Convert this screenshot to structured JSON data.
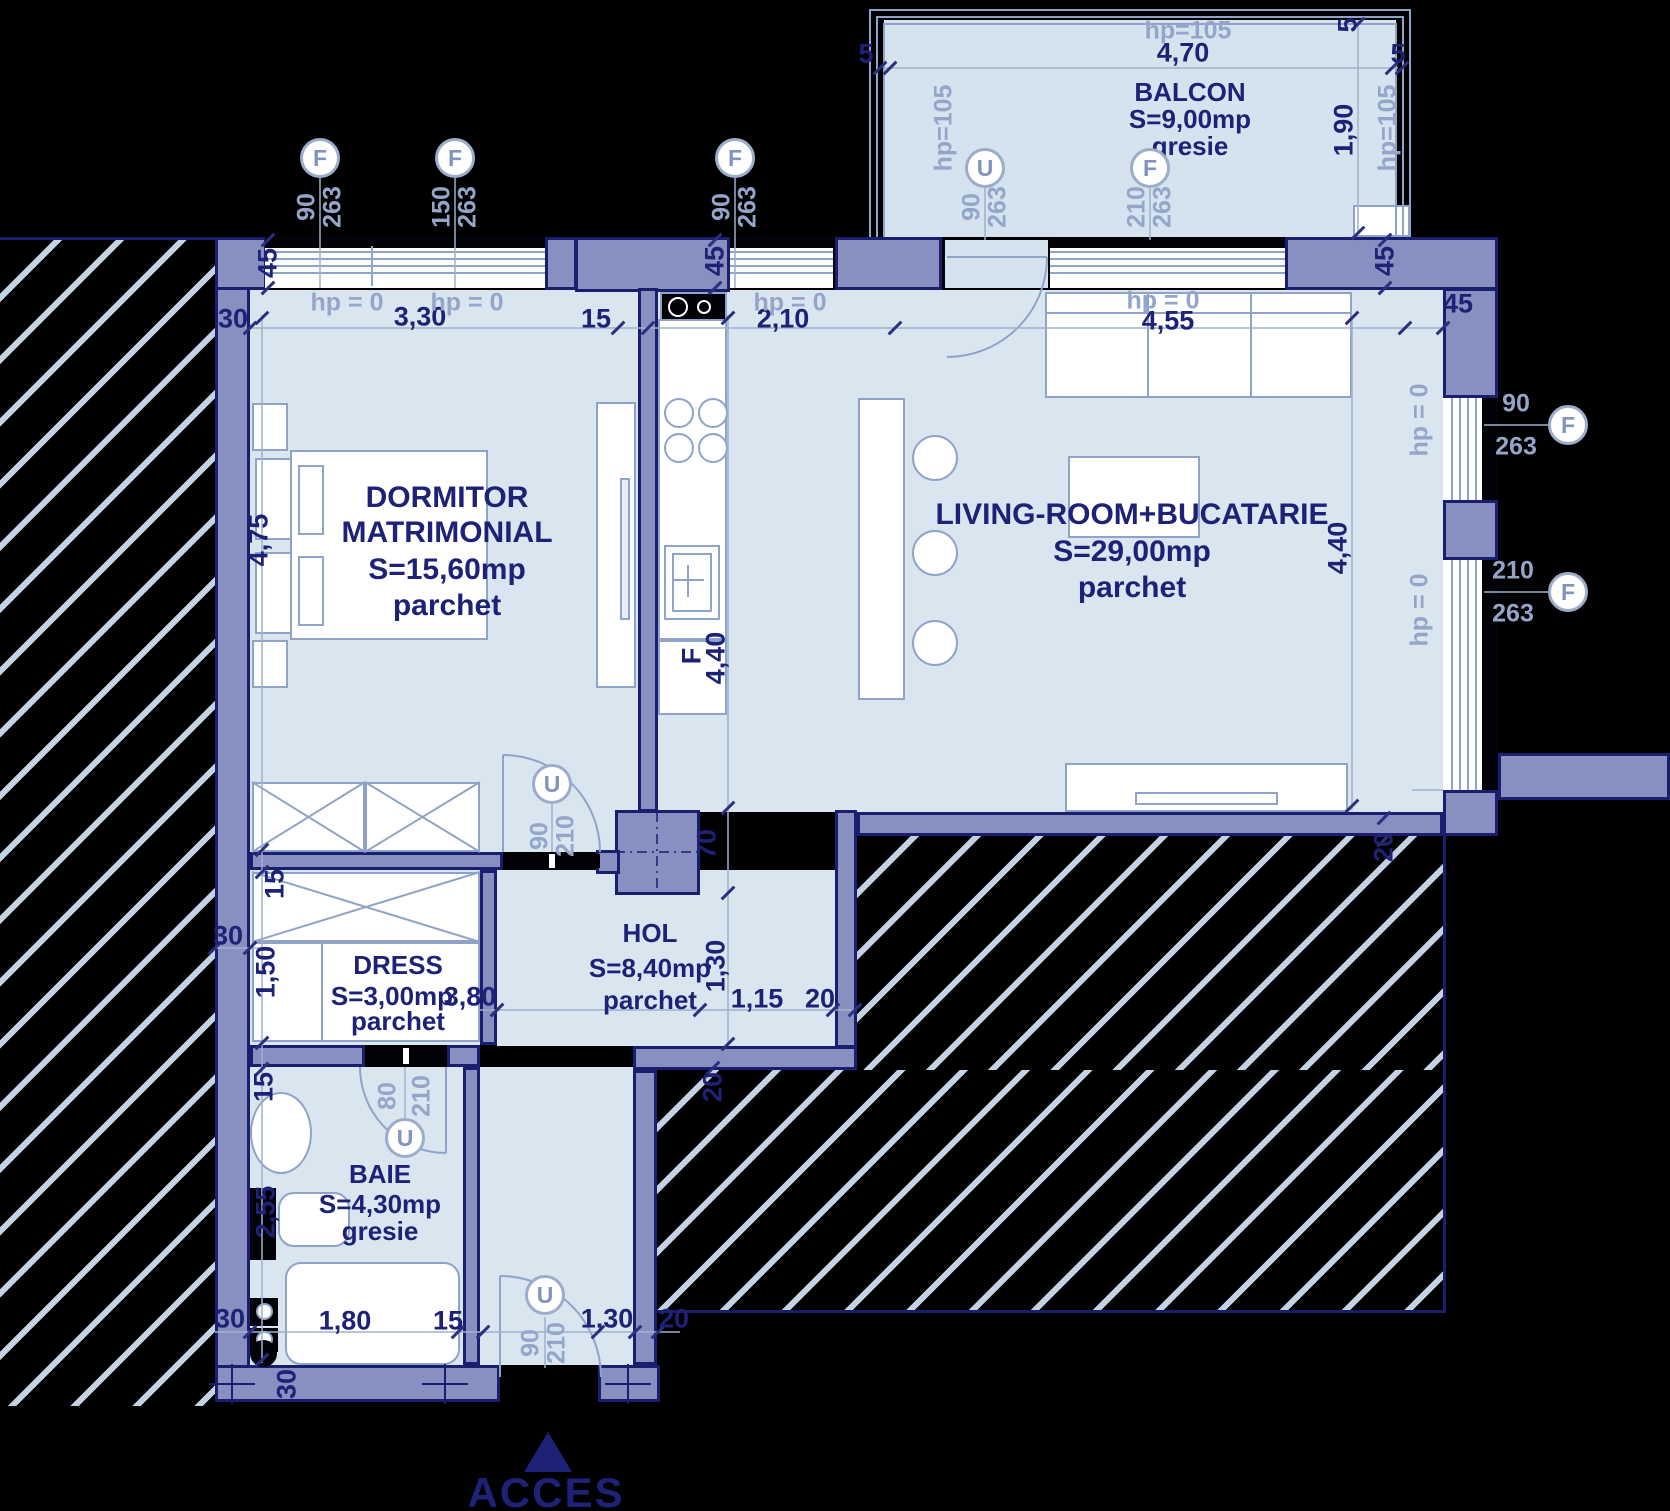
{
  "rooms": {
    "dormitor": {
      "name1": "DORMITOR",
      "name2": "MATRIMONIAL",
      "area": "S=15,60mp",
      "finish": "parchet"
    },
    "living": {
      "name": "LIVING-ROOM+BUCATARIE",
      "area": "S=29,00mp",
      "finish": "parchet"
    },
    "balcon": {
      "name": "BALCON",
      "area": "S=9,00mp",
      "finish": "gresie"
    },
    "hol": {
      "name": "HOL",
      "area": "S=8,40mp",
      "finish": "parchet"
    },
    "dress": {
      "name": "DRESS",
      "area": "S=3,00mp",
      "finish": "parchet"
    },
    "baie": {
      "name": "BAIE",
      "area": "S=4,30mp",
      "finish": "gresie"
    }
  },
  "entry": {
    "label": "ACCES"
  },
  "symbols": {
    "window_letter": "F",
    "door_letter": "U"
  },
  "sizes": {
    "s80": "80",
    "s90": "90",
    "s150": "150",
    "s210": "210",
    "s263": "263"
  },
  "levels": {
    "hp0": "hp = 0",
    "hp105": "hp=105"
  },
  "dimensions": {
    "w330": "3,30",
    "w210": "2,10",
    "w455": "4,55",
    "w470": "4,70",
    "w190": "1,90",
    "h475": "4,75",
    "h440": "4,40",
    "h150": "1,50",
    "h255": "2,55",
    "w180": "1,80",
    "w130": "1,30",
    "w115": "1,15",
    "w380": "3,80",
    "t45": "45",
    "t30": "30",
    "t15": "15",
    "t20": "20",
    "t70": "70",
    "t5": "5",
    "fridge": "F"
  },
  "colors": {
    "wall": "#8790c0",
    "outline": "#1a1e6f",
    "floor": "#d9e6f0",
    "dark_text": "#1d2277",
    "light_text": "#93a6ca"
  }
}
